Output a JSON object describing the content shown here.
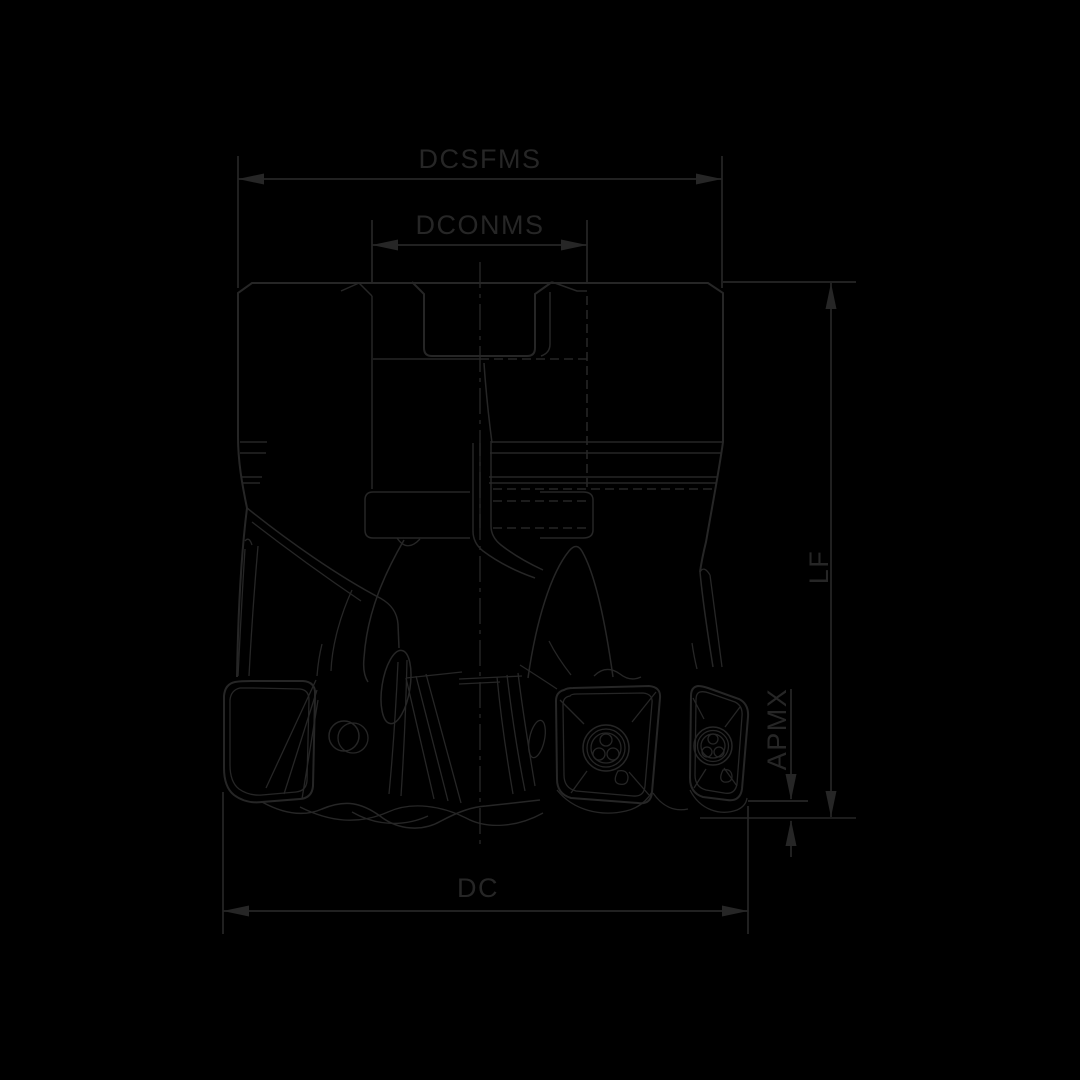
{
  "colors": {
    "background": "#000000",
    "ink": "#262626"
  },
  "drawing": {
    "labels": {
      "dcsfms": "DCSFMS",
      "dconms": "DCONMS",
      "lf": "LF",
      "apmx": "APMX",
      "dc": "DC"
    }
  }
}
